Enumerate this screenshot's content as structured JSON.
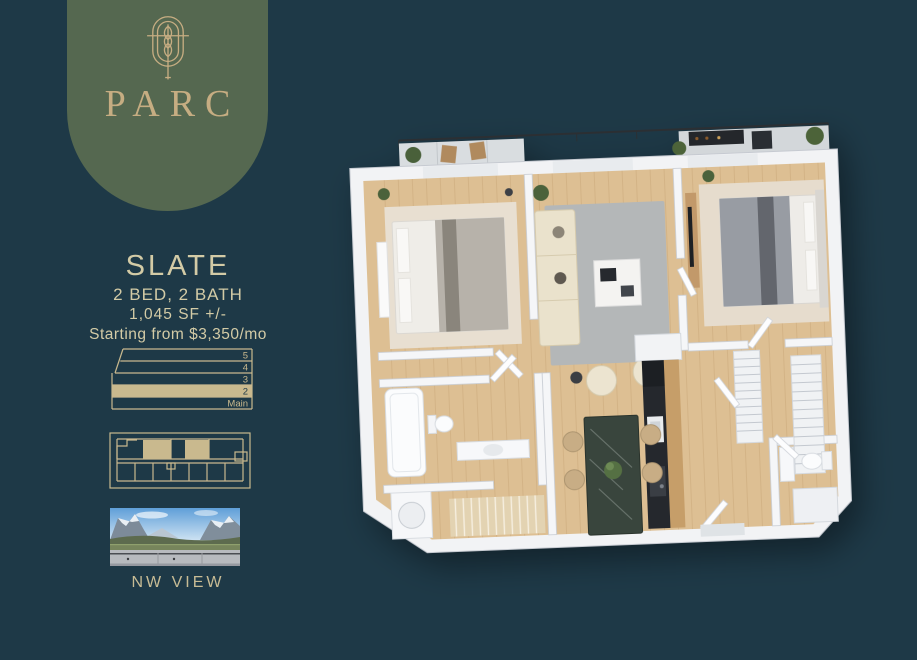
{
  "colors": {
    "background": "#1e3947",
    "badge_green": "#556850",
    "gold_accent": "#c6ad82",
    "text_khaki": "#d3cba6",
    "diagram_gold": "#c9b98e"
  },
  "brand": {
    "name": "PARC",
    "logo_icon": "wheat-emblem-icon"
  },
  "unit": {
    "name": "SLATE",
    "beds_baths": "2 BED, 2 BATH",
    "area": "1,045 SF +/-",
    "price": "Starting from $3,350/mo"
  },
  "floor_stack": {
    "floors": [
      "5",
      "4",
      "3",
      "2",
      "Main"
    ],
    "highlighted_floor": "2"
  },
  "view": {
    "label": "NW VIEW"
  }
}
